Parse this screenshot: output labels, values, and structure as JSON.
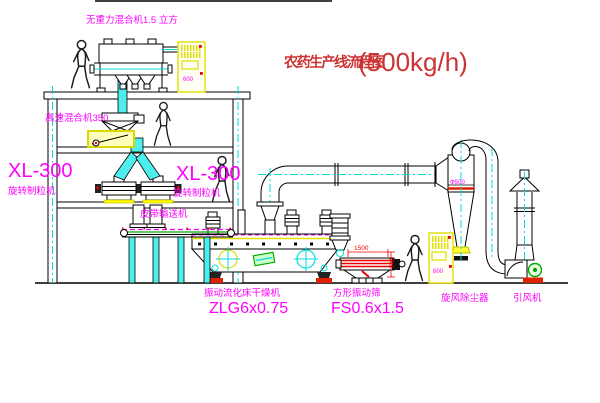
{
  "title": {
    "text": "农药生产线流程图",
    "capacity": "(500kg/h)"
  },
  "equipment": {
    "gravity_mixer": {
      "label": "无重力混合机1.5 立方"
    },
    "high_speed_mixer": {
      "label": "高速混合机350"
    },
    "granulator_left": {
      "model": "XL-300",
      "name": "旋转制粒机"
    },
    "granulator_right": {
      "model": "XL-300",
      "name": "旋转制粒机"
    },
    "belt_conveyor": {
      "label": "皮带输送机"
    },
    "fluid_bed_dryer": {
      "name": "振动流化床干燥机",
      "model": "ZLG6x0.75"
    },
    "vibrating_screen": {
      "name": "方形振动筛",
      "model": "FS0.6x1.5"
    },
    "cyclone": {
      "label": "旋风除尘器",
      "dim": "Φ500"
    },
    "fan": {
      "label": "引风机"
    },
    "control_cabinet_top": {
      "label": "600"
    },
    "control_cabinet_bottom": {
      "label": "600"
    }
  },
  "dimensions": {
    "screen_width": "1500",
    "screen_height": "541"
  },
  "colors": {
    "label_magenta": "#ff00ff",
    "title_red": "#cc3333",
    "pipe_cyan": "#00dddd",
    "highlight_yellow": "#ffff00",
    "dimension_red": "#ee0000",
    "accent_green": "#00aa00",
    "base_red": "#dd2200"
  }
}
